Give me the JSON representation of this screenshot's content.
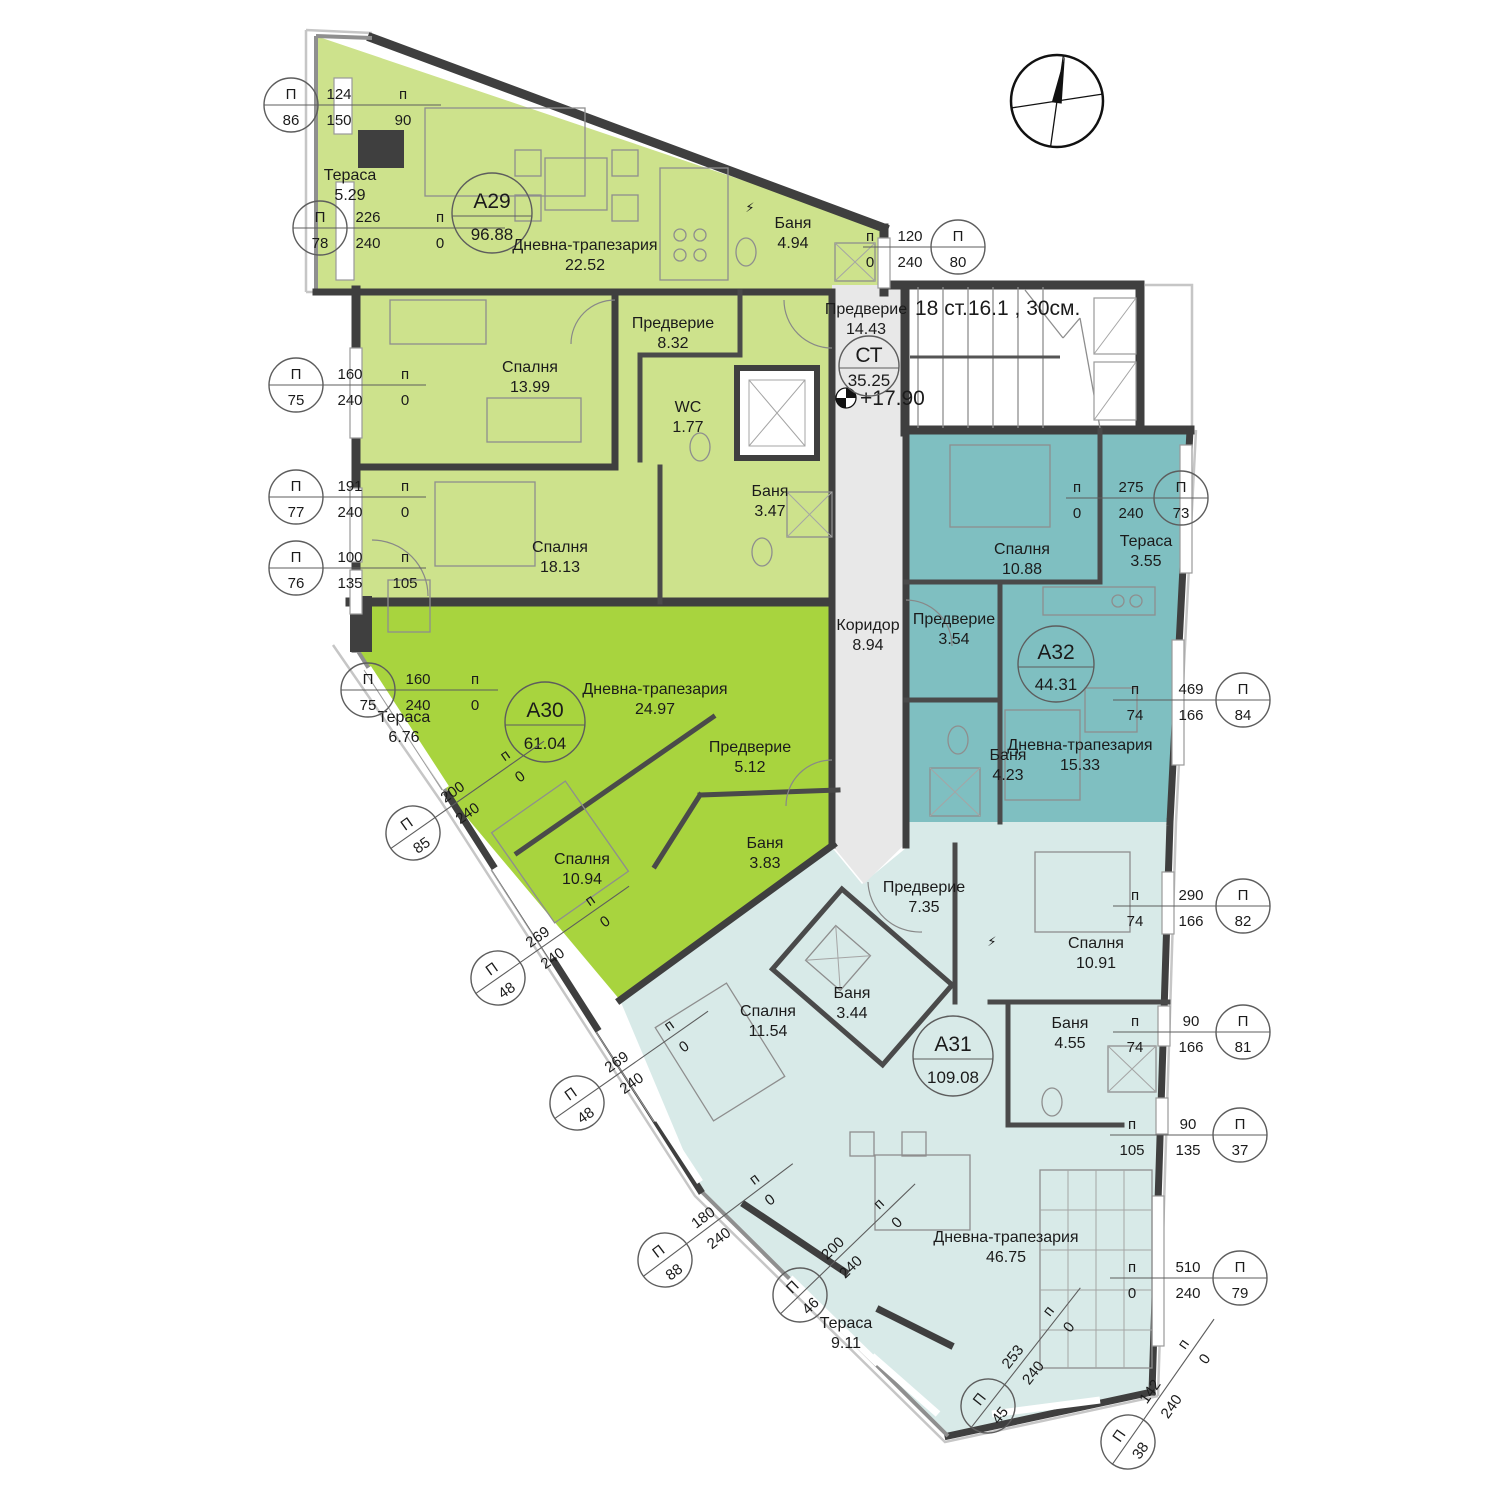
{
  "labels": {
    "window_prefix": "П",
    "sill_prefix": "п"
  },
  "core": {
    "lobby_name": "Предверие",
    "lobby_area": "14.43",
    "stair_id": "СТ",
    "stair_area": "35.25",
    "stair_note": "18 ст.16.1 , 30см.",
    "level": "+17.90",
    "corridor_name": "Коридор",
    "corridor_area": "8.94"
  },
  "apartments": [
    {
      "id": "А29",
      "area": "96.88",
      "color": "#cde28c",
      "rooms": [
        {
          "name": "Тераса",
          "area": "5.29"
        },
        {
          "name": "Дневна-трапезария",
          "area": "22.52"
        },
        {
          "name": "Баня",
          "area": "4.94"
        },
        {
          "name": "Предверие",
          "area": "8.32"
        },
        {
          "name": "Спалня",
          "area": "13.99"
        },
        {
          "name": "WC",
          "area": "1.77"
        },
        {
          "name": "Баня",
          "area": "3.47"
        },
        {
          "name": "Спалня",
          "area": "18.13"
        }
      ]
    },
    {
      "id": "А30",
      "area": "61.04",
      "color": "#a8d43e",
      "rooms": [
        {
          "name": "Тераса",
          "area": "6.76"
        },
        {
          "name": "Дневна-трапезария",
          "area": "24.97"
        },
        {
          "name": "Предверие",
          "area": "5.12"
        },
        {
          "name": "Баня",
          "area": "3.83"
        },
        {
          "name": "Спалня",
          "area": "10.94"
        }
      ]
    },
    {
      "id": "А31",
      "area": "109.08",
      "color": "#d8eae8",
      "rooms": [
        {
          "name": "Спалня",
          "area": "11.54"
        },
        {
          "name": "Баня",
          "area": "3.44"
        },
        {
          "name": "Предверие",
          "area": "7.35"
        },
        {
          "name": "Спалня",
          "area": "10.91"
        },
        {
          "name": "Баня",
          "area": "4.55"
        },
        {
          "name": "Дневна-трапезария",
          "area": "46.75"
        },
        {
          "name": "Тераса",
          "area": "9.11"
        }
      ]
    },
    {
      "id": "А32",
      "area": "44.31",
      "color": "#7fbfc1",
      "rooms": [
        {
          "name": "Спалня",
          "area": "10.88"
        },
        {
          "name": "Тераса",
          "area": "3.55"
        },
        {
          "name": "Предверие",
          "area": "3.54"
        },
        {
          "name": "Баня",
          "area": "4.23"
        },
        {
          "name": "Дневна-трапезария",
          "area": "15.33"
        }
      ]
    }
  ],
  "callouts": [
    {
      "num": "86",
      "dim1": "124",
      "dim2": "150",
      "sill": "90"
    },
    {
      "num": "78",
      "dim1": "226",
      "dim2": "240",
      "sill": "0"
    },
    {
      "num": "75",
      "dim1": "160",
      "dim2": "240",
      "sill": "0"
    },
    {
      "num": "77",
      "dim1": "191",
      "dim2": "240",
      "sill": "0"
    },
    {
      "num": "76",
      "dim1": "100",
      "dim2": "135",
      "sill": "105"
    },
    {
      "num": "75",
      "dim1": "160",
      "dim2": "240",
      "sill": "0"
    },
    {
      "num": "85",
      "dim1": "200",
      "dim2": "240",
      "sill": "0"
    },
    {
      "num": "48",
      "dim1": "269",
      "dim2": "240",
      "sill": "0"
    },
    {
      "num": "48",
      "dim1": "269",
      "dim2": "240",
      "sill": "0"
    },
    {
      "num": "88",
      "dim1": "180",
      "dim2": "240",
      "sill": "0"
    },
    {
      "num": "46",
      "dim1": "200",
      "dim2": "240",
      "sill": "0"
    },
    {
      "num": "45",
      "dim1": "253",
      "dim2": "240",
      "sill": "0"
    },
    {
      "num": "38",
      "dim1": "142",
      "dim2": "240",
      "sill": "0"
    },
    {
      "num": "80",
      "dim1": "120",
      "dim2": "240",
      "sill": "0"
    },
    {
      "num": "73",
      "dim1": "275",
      "dim2": "240",
      "sill": "0"
    },
    {
      "num": "84",
      "dim1": "469",
      "dim2": "166",
      "sill": "74"
    },
    {
      "num": "82",
      "dim1": "290",
      "dim2": "166",
      "sill": "74"
    },
    {
      "num": "81",
      "dim1": "90",
      "dim2": "166",
      "sill": "74"
    },
    {
      "num": "37",
      "dim1": "90",
      "dim2": "135",
      "sill": "105"
    },
    {
      "num": "79",
      "dim1": "510",
      "dim2": "240",
      "sill": "0"
    }
  ]
}
